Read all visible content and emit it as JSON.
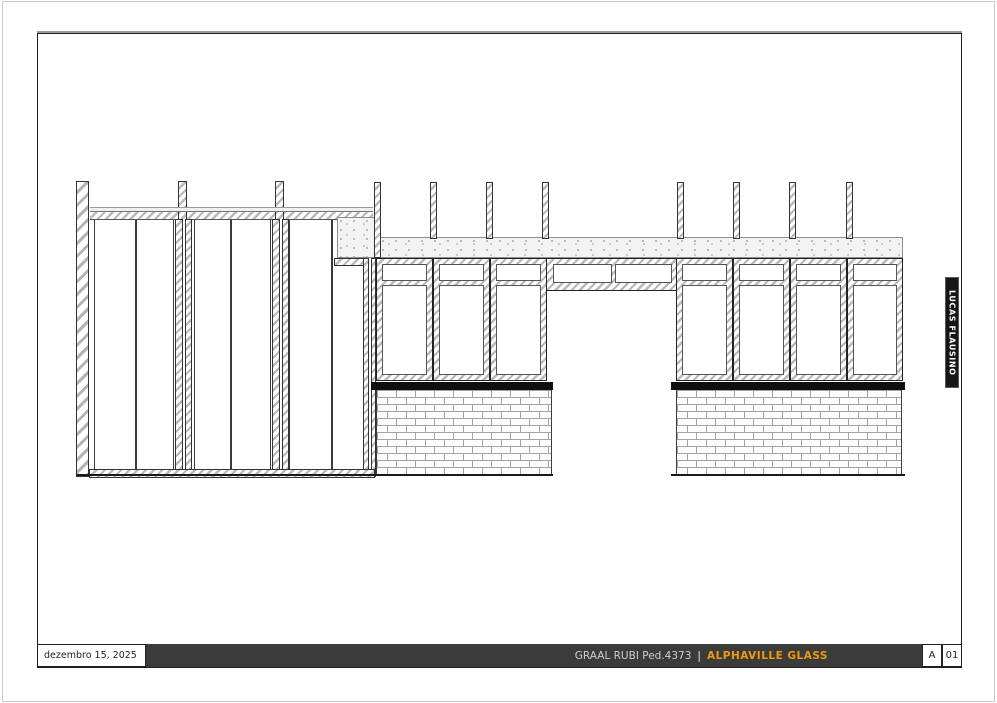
{
  "title_block": {
    "date": "dezembro 15, 2025",
    "project": "GRAAL RUBI Ped.4373",
    "separator": "|",
    "company": "ALPHAVILLE GLASS",
    "revision": "A",
    "sheet_number": "01",
    "bar_background": "#3b3b3b",
    "company_color": "#EF9A0E"
  },
  "side_tab": {
    "text": "LUCAS FLAUSINO",
    "background": "#161616",
    "text_color": "#ffffff"
  },
  "drawing": {
    "type": "architectural-elevation",
    "left_glass_panels": 6,
    "window_group_left_count": 3,
    "window_group_right_count": 4,
    "door_transom_panes": 2,
    "sill_color": "#0f0f0f",
    "hatch_color": "#b9b9b9"
  }
}
